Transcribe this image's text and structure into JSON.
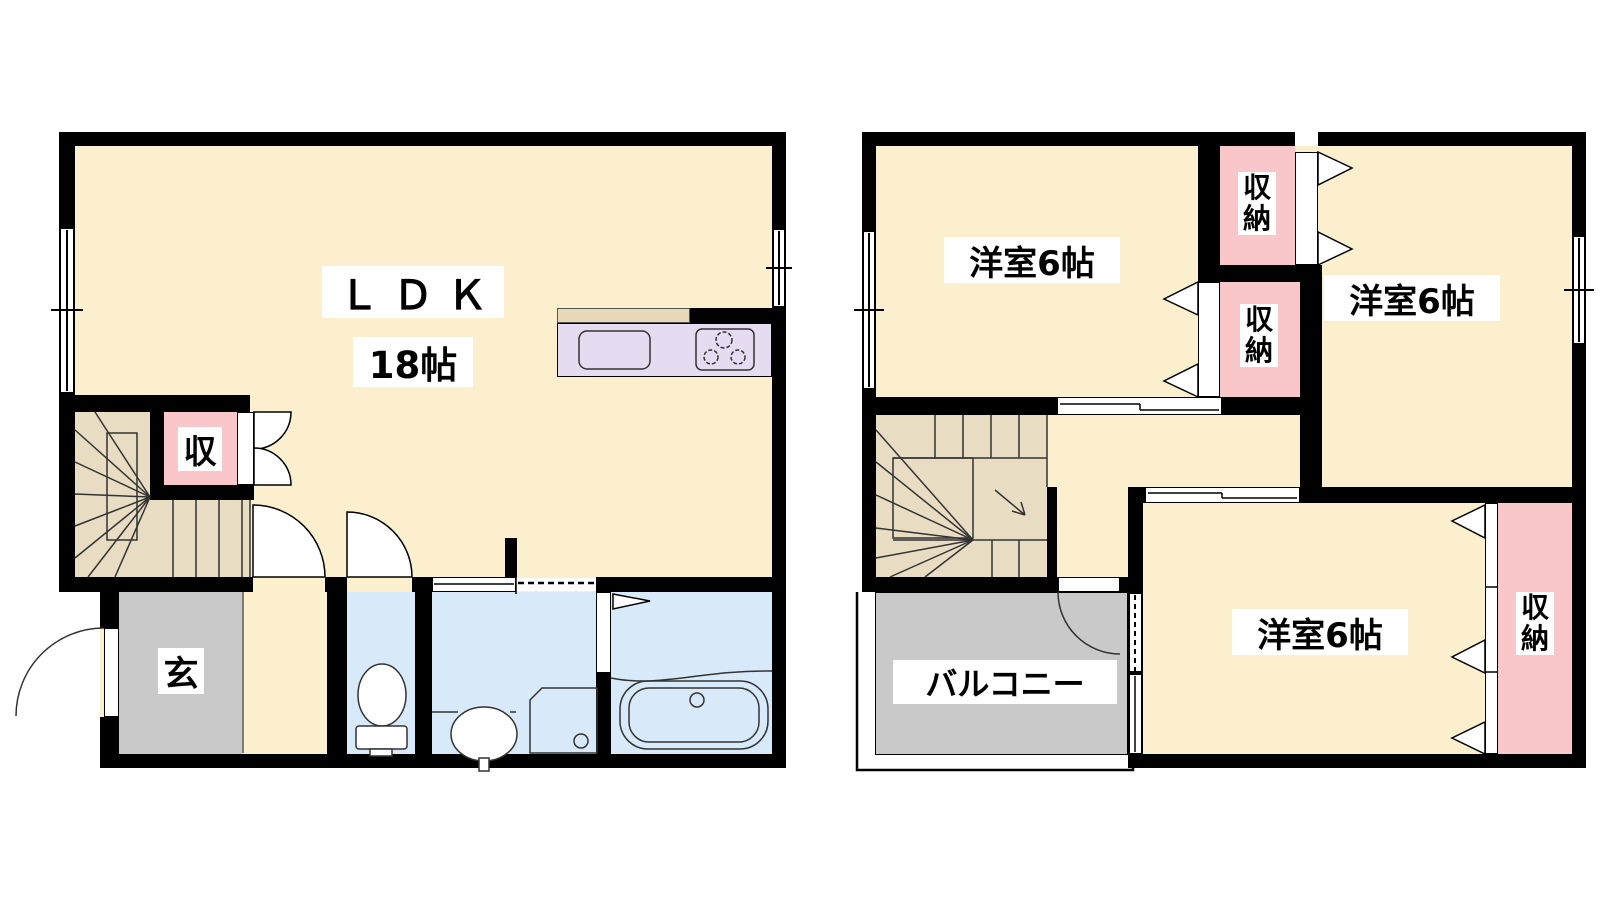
{
  "floorplan": {
    "floor1": {
      "ldk_label": "ＬＤＫ",
      "ldk_size": "18帖",
      "storage_label": "収",
      "entrance_label": "玄"
    },
    "floor2": {
      "room_nw_label": "洋室6帖",
      "room_ne_label": "洋室6帖",
      "room_s_label": "洋室6帖",
      "closet_n_label": "収納",
      "closet_mid_label": "収納",
      "closet_e_label": "収納",
      "balcony_label": "バルコニー"
    },
    "colors": {
      "wall": "#000000",
      "cream": "#FBEFCD",
      "tan": "#E8DCC2",
      "pink": "#F9C6CA",
      "purple": "#E6DCF2",
      "beige": "#E8D9B9",
      "blue": "#D8E9FA",
      "gray": "#C9C9C9"
    }
  }
}
